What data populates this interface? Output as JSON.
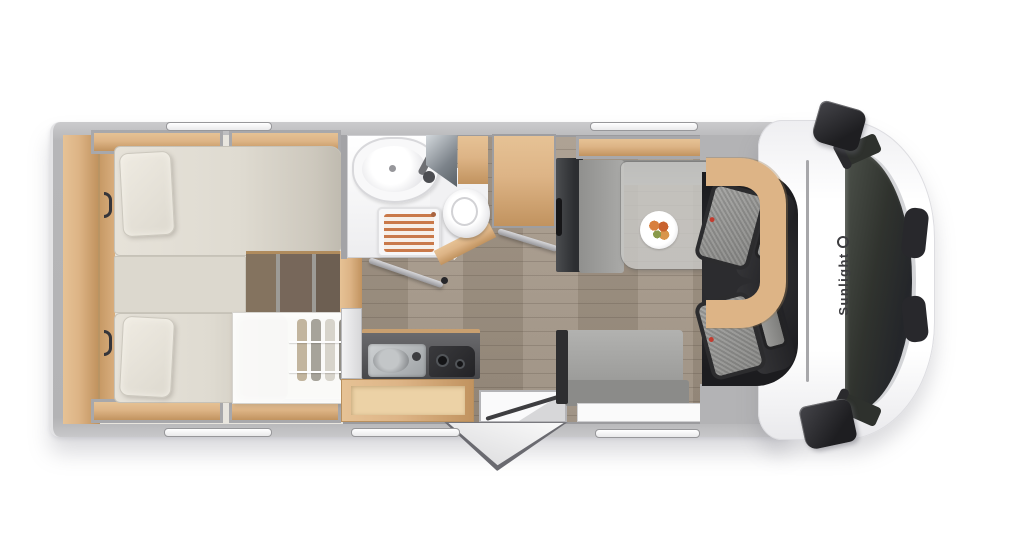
{
  "brand": {
    "label": "Sunlight",
    "logo_icon": "sunlight-ring-logo"
  },
  "palette": {
    "wood": "#ddb486",
    "wood-dark": "#c1935f",
    "floor": "#a89b8c",
    "floor-dark": "#998c7d",
    "mattress": "#dfdbd1",
    "slat": "#c9794a",
    "wall": "#b3b3b5",
    "body-white": "#ffffff",
    "seat-dark": "#2c2c2e",
    "seat-fabric": "#9e9e9c",
    "brand-ink": "#3d3d40"
  }
}
